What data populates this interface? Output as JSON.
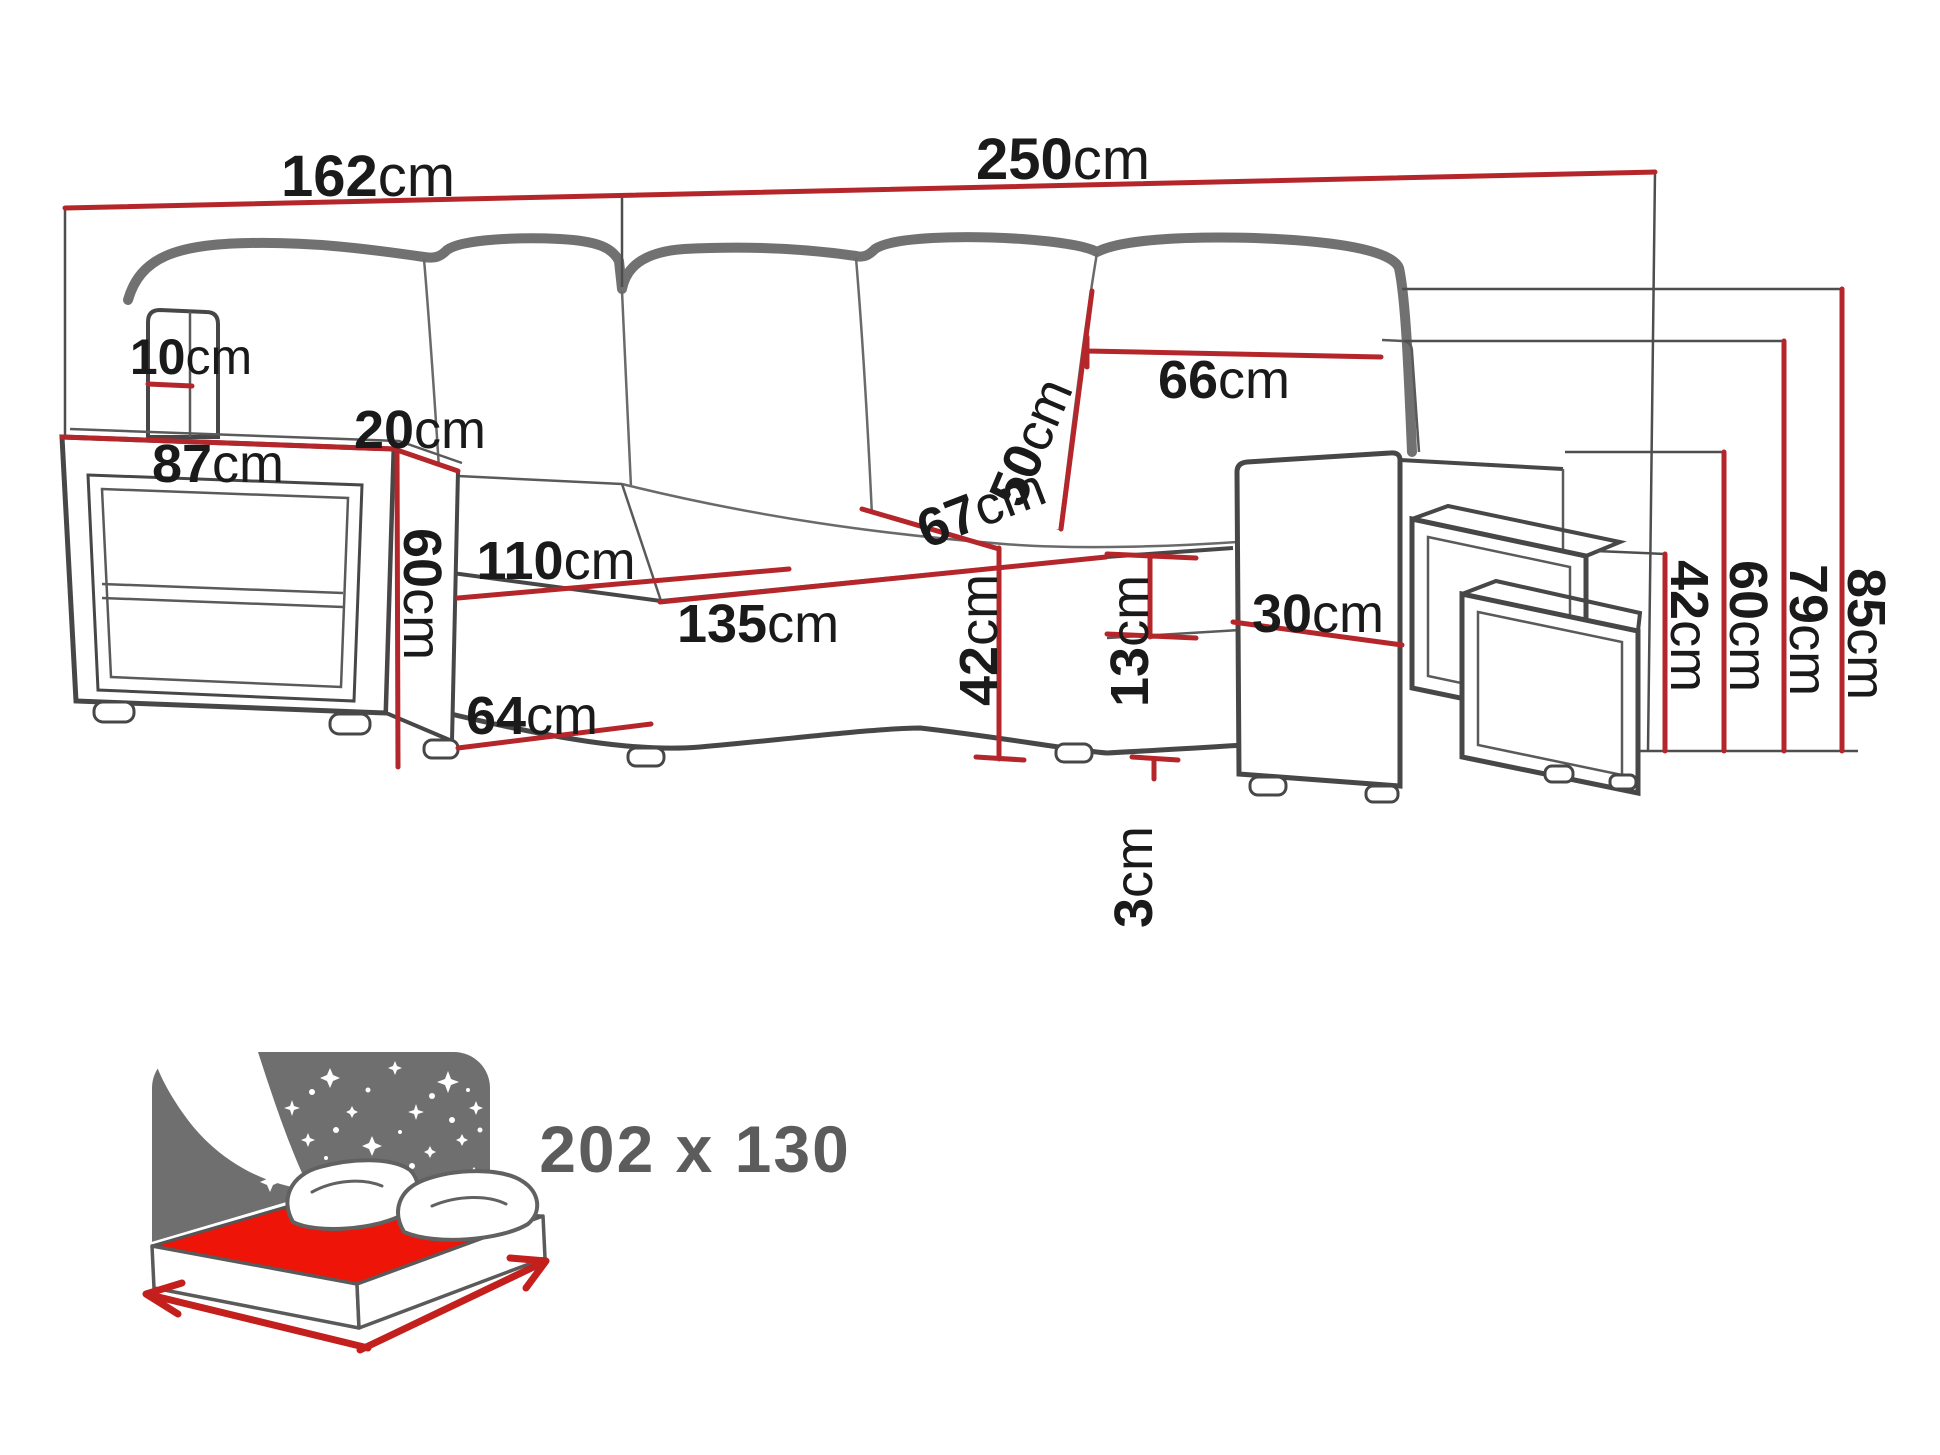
{
  "diagram": {
    "type": "furniture-dimension-diagram",
    "subject": "corner sofa bed with shelf armrest and nesting stools",
    "unit": "cm",
    "colors": {
      "dimension_line": "#b5262b",
      "extension_line": "#4e4e4e",
      "label_text": "#1a1a1a",
      "furniture_outline": "#474747",
      "icon_gray": "#6f6f6f",
      "mattress_red": "#ee1408",
      "arrow_red": "#c31f1c",
      "icon_text_gray": "#5c5c5c"
    },
    "dims": {
      "w162": {
        "num": "162",
        "unit": "cm"
      },
      "w250": {
        "num": "250",
        "unit": "cm"
      },
      "t10": {
        "num": "10",
        "unit": "cm"
      },
      "t20": {
        "num": "20",
        "unit": "cm"
      },
      "t87": {
        "num": "87",
        "unit": "cm"
      },
      "t60l": {
        "num": "60",
        "unit": "cm"
      },
      "t110": {
        "num": "110",
        "unit": "cm"
      },
      "t135": {
        "num": "135",
        "unit": "cm"
      },
      "t64": {
        "num": "64",
        "unit": "cm"
      },
      "t50": {
        "num": "50",
        "unit": "cm"
      },
      "t66": {
        "num": "66",
        "unit": "cm"
      },
      "t67": {
        "num": "67",
        "unit": "cm"
      },
      "t30": {
        "num": "30",
        "unit": "cm"
      },
      "t42seat": {
        "num": "42",
        "unit": "cm"
      },
      "t13": {
        "num": "13",
        "unit": "cm"
      },
      "t3": {
        "num": "3",
        "unit": "cm"
      },
      "r42": {
        "num": "42",
        "unit": "cm"
      },
      "r60": {
        "num": "60",
        "unit": "cm"
      },
      "r79": {
        "num": "79",
        "unit": "cm"
      },
      "r85": {
        "num": "85",
        "unit": "cm"
      }
    },
    "sleep_icon": {
      "size": "202 x 130"
    }
  }
}
